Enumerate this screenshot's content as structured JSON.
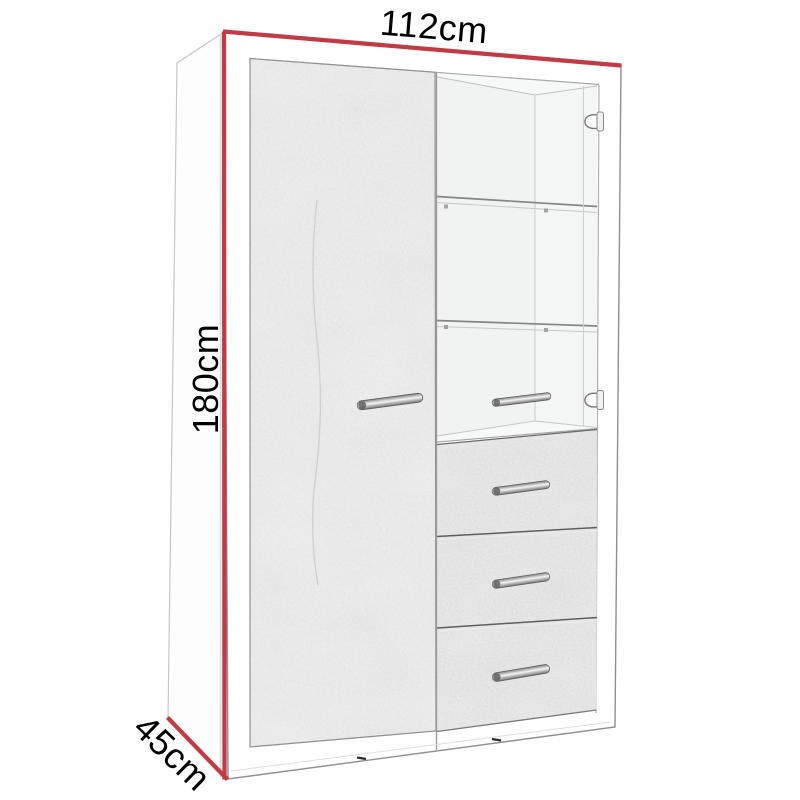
{
  "title": "Furniture dimension diagram",
  "subject": "Tall display cabinet with concrete-effect door, glass display section and three drawers",
  "dimensions": {
    "width": "112cm",
    "height": "180cm",
    "depth": "45cm"
  },
  "colors": {
    "dimension_line": "#c13b45",
    "label_text": "#000000",
    "background": "#ffffff",
    "concrete": "#dcdcdc",
    "carcass_white": "#ffffff",
    "handle_metal": "#c9c9c9"
  }
}
